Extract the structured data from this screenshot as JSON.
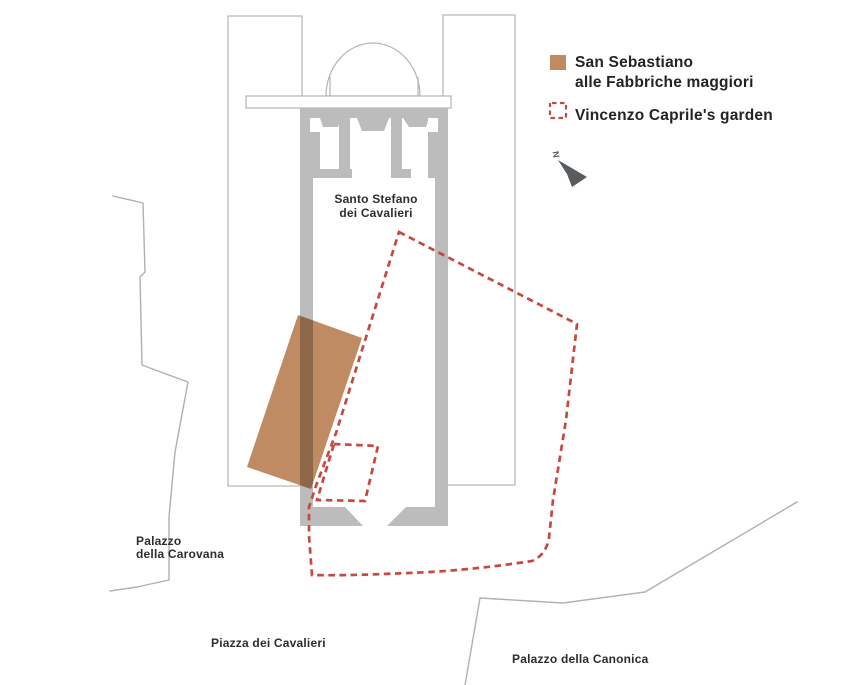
{
  "legend": {
    "san_sebastiano": {
      "line1": "San Sebastiano",
      "line2": "alle Fabbriche maggiori",
      "swatch": "filled-square",
      "color": "#c08b62"
    },
    "garden": {
      "label": "Vincenzo Caprile's garden",
      "swatch": "dashed-square-outline",
      "color": "#c6483e"
    },
    "north_arrow": {
      "letter": "N",
      "arrow_color": "#575c60"
    }
  },
  "map": {
    "labels": {
      "church": {
        "line1": "Santo Stefano",
        "line2": "dei Cavalieri"
      },
      "carovana": {
        "line1": "Palazzo",
        "line2": "della Carovana"
      },
      "piazza": "Piazza dei Cavalieri",
      "canonica": "Palazzo della Canonica"
    },
    "colors": {
      "walls": "#bcbcbc",
      "building_outlines": "#b4b4b4",
      "context_lines": "#b0b0b0",
      "san_sebastiano_fill": "#c08b62",
      "garden_dash": "#c6483e",
      "label_text": "#2d2d2d"
    }
  }
}
